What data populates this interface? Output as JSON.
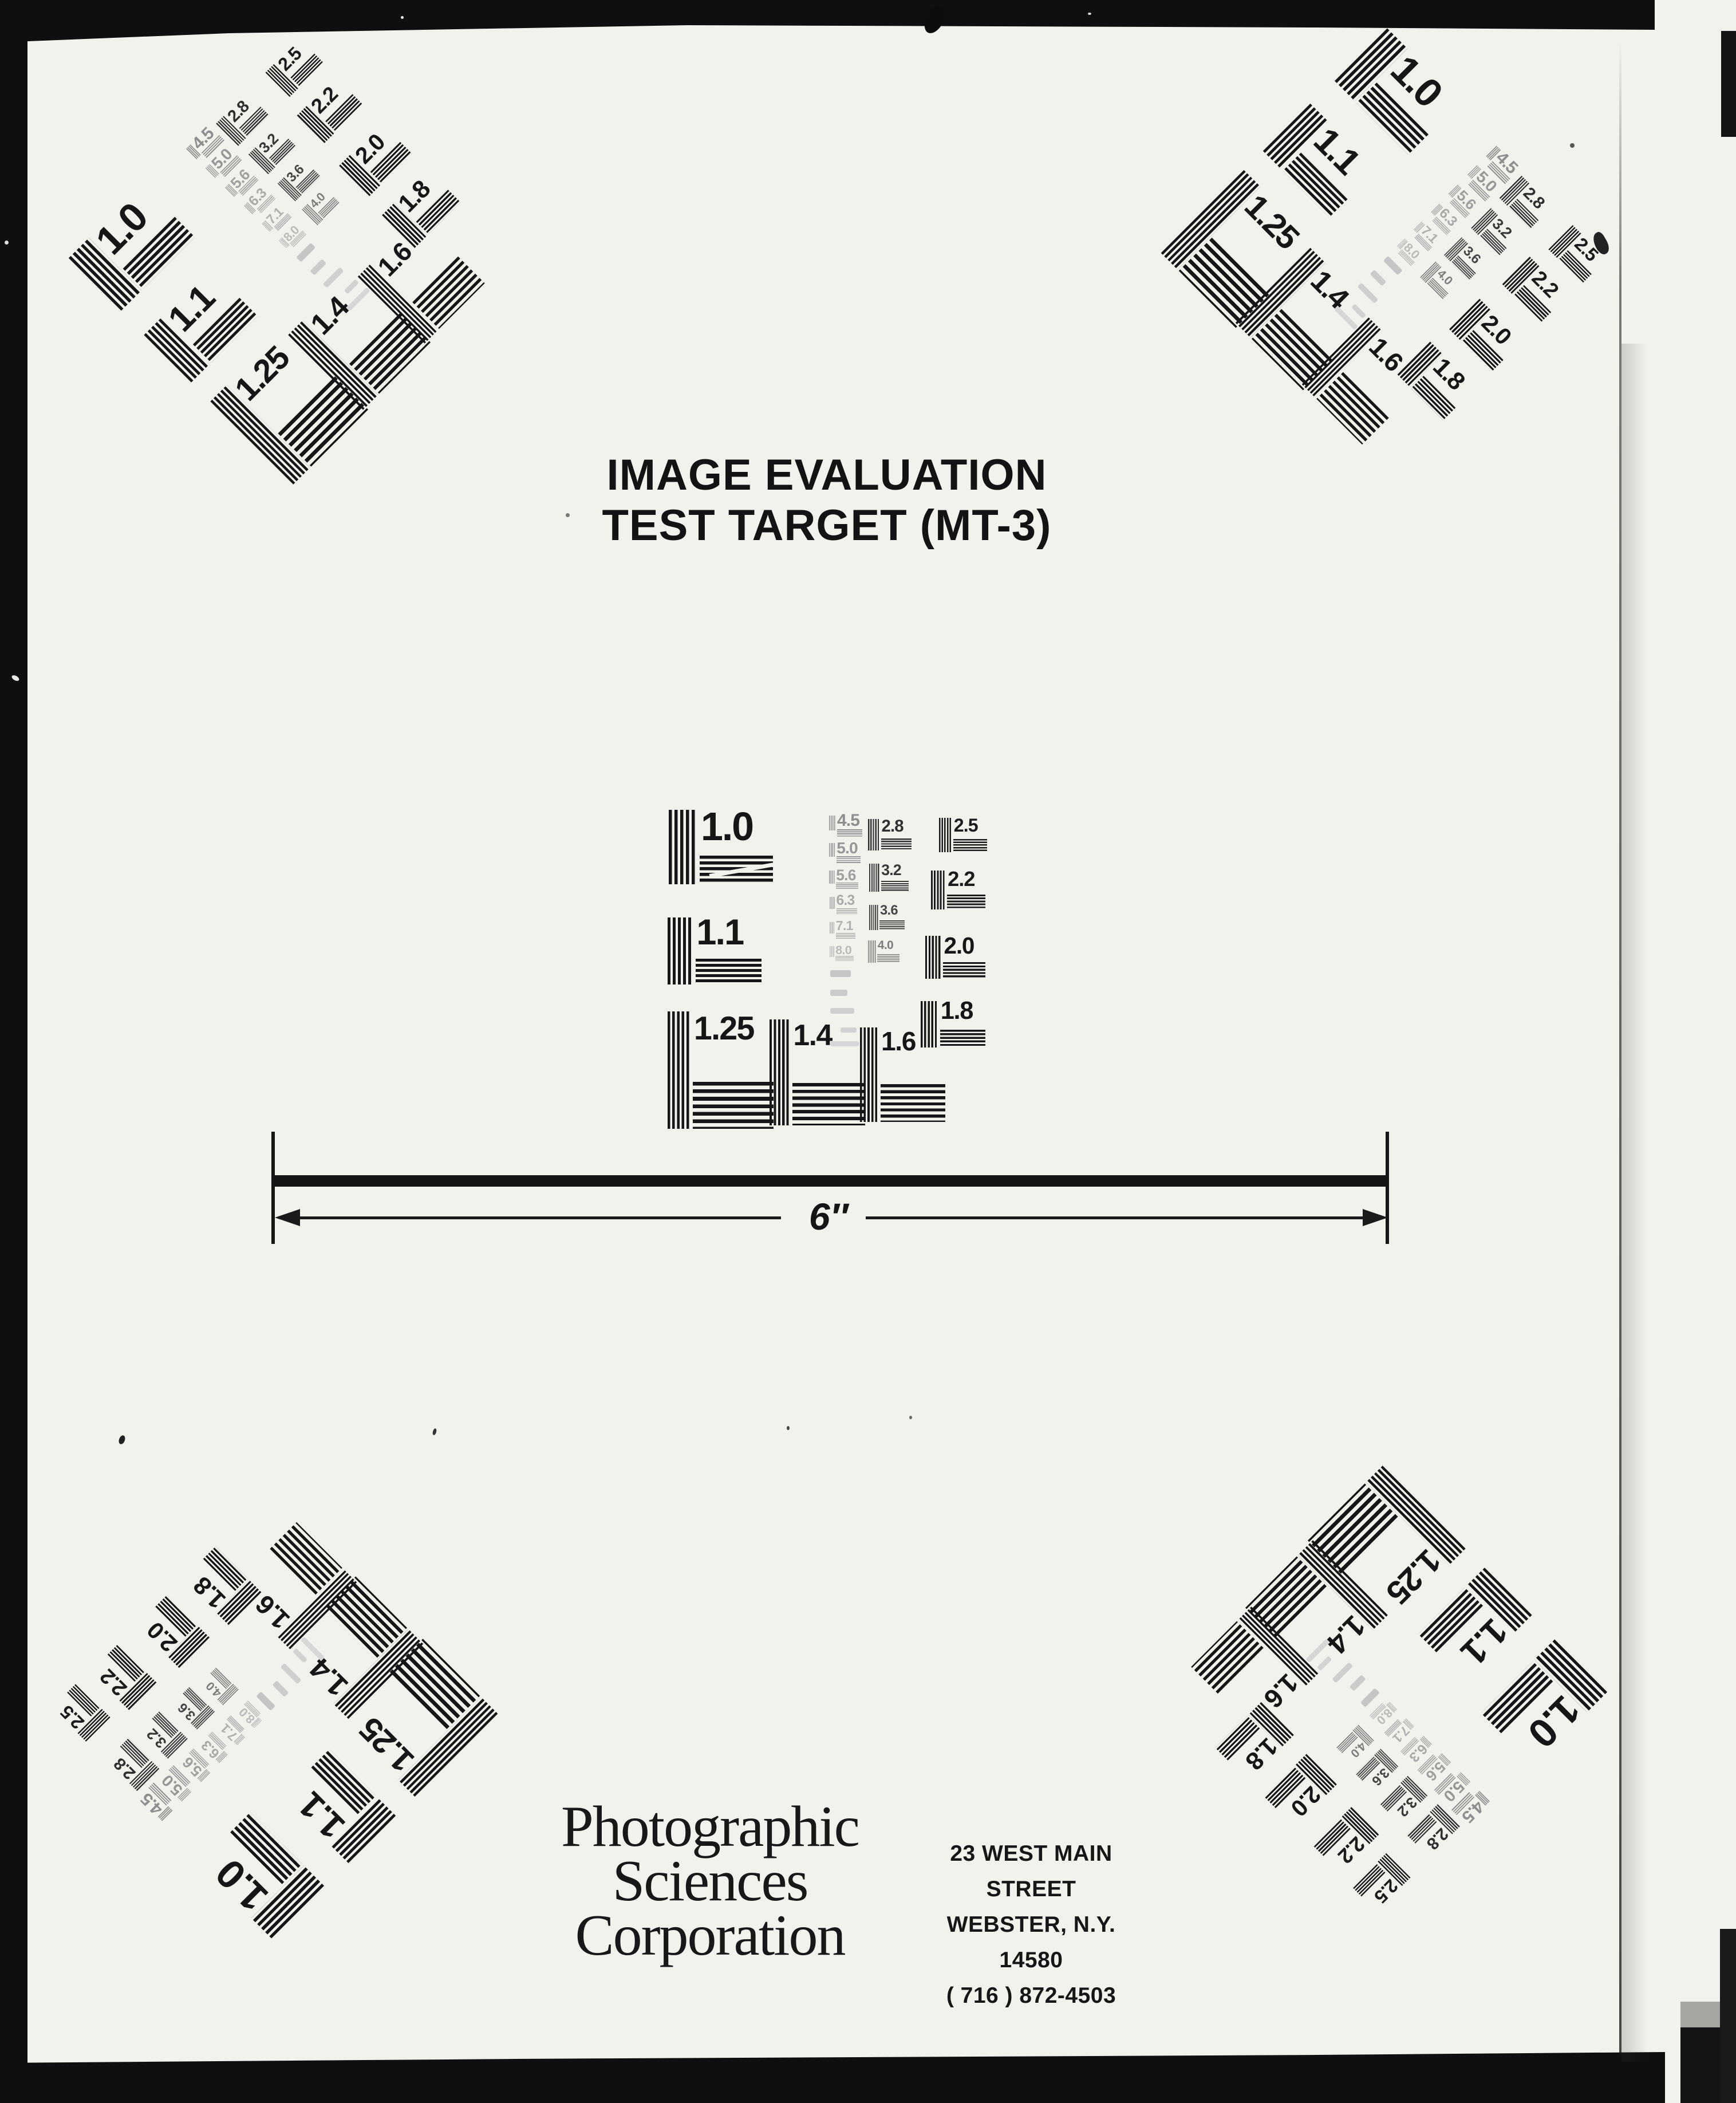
{
  "title": {
    "line1": "IMAGE EVALUATION",
    "line2": "TEST TARGET (MT-3)"
  },
  "scale_bar": {
    "length_label": "6″"
  },
  "footer": {
    "company_lines": [
      "Photographic",
      "Sciences",
      "Corporation"
    ],
    "address_lines": [
      "23 WEST MAIN STREET",
      "WEBSTER, N.Y. 14580",
      "( 716 ) 872-4503"
    ]
  },
  "test_target": {
    "patch_labels_large": [
      "1.0",
      "1.1",
      "1.25",
      "1.4",
      "1.6",
      "1.8",
      "2.0",
      "2.2",
      "2.5"
    ],
    "patch_labels_medium": [
      "2.8",
      "3.2",
      "3.6",
      "4.0"
    ],
    "patch_labels_small_gray": [
      "4.5",
      "5.0",
      "5.6",
      "6.3",
      "7.1",
      "8.0"
    ],
    "instances": [
      {
        "position": "top-left",
        "rotation_deg": -45
      },
      {
        "position": "top-right",
        "rotation_deg": 45
      },
      {
        "position": "center",
        "rotation_deg": 0
      },
      {
        "position": "bottom-left",
        "rotation_deg": -135
      },
      {
        "position": "bottom-right",
        "rotation_deg": 135
      }
    ]
  }
}
